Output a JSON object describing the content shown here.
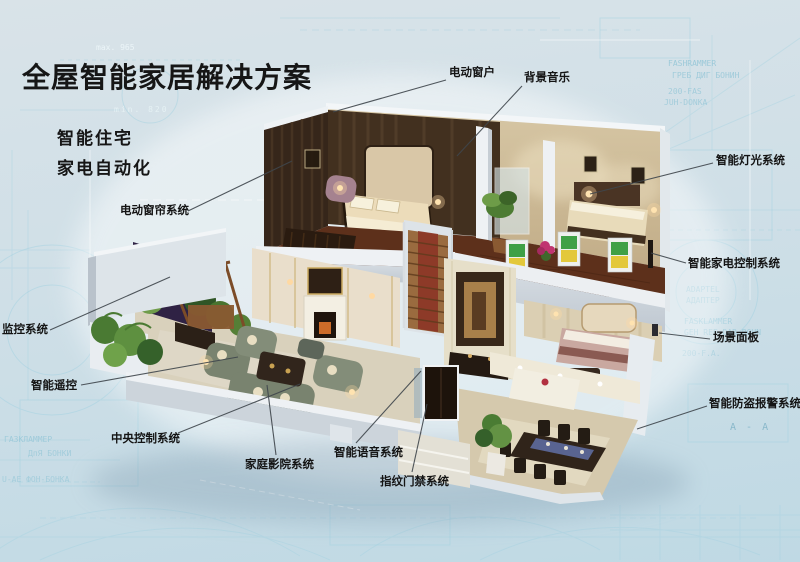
{
  "title": "全屋智能家居解决方案",
  "subtitles": [
    "智能住宅",
    "家电自动化"
  ],
  "callouts": [
    {
      "id": "electric-window",
      "text": "电动窗户"
    },
    {
      "id": "background-music",
      "text": "背景音乐"
    },
    {
      "id": "smart-lighting",
      "text": "智能灯光系统"
    },
    {
      "id": "smart-appliance-control",
      "text": "智能家电控制系统"
    },
    {
      "id": "scene-panel",
      "text": "场景面板"
    },
    {
      "id": "anti-theft-alarm",
      "text": "智能防盗报警系统"
    },
    {
      "id": "electric-curtain",
      "text": "电动窗帘系统"
    },
    {
      "id": "surveillance",
      "text": "监控系统"
    },
    {
      "id": "smart-remote",
      "text": "智能遥控"
    },
    {
      "id": "central-control",
      "text": "中央控制系统"
    },
    {
      "id": "home-theater",
      "text": "家庭影院系统"
    },
    {
      "id": "smart-voice",
      "text": "智能语音系统"
    },
    {
      "id": "fingerprint-access",
      "text": "指纹门禁系统"
    }
  ],
  "blueprint_marks": [
    "max. 965",
    "min. 820",
    "FASHRAMMER",
    "ГРЕБ ДИГ БОНИН",
    "200-FAS",
    "JUH-DONKA",
    "ADAPTEL",
    "АДАПТЕР",
    "FASKLAMMER",
    "GEH REF DAR BOHN",
    "200-F.A.",
    "A - A",
    "ГАЗКЛАММЕР",
    "ДпЯ БОНКИ",
    "U-АЕ ФОН-БОНКА"
  ],
  "colors": {
    "background_top": "#d9e3e8",
    "background_bottom": "#bfd9e4",
    "blueprint_line": "#9fd0e0",
    "title_color": "#161616",
    "label_color": "#141414",
    "leader_line": "#3f464c",
    "appliance_green": "#3fa046",
    "appliance_yellow": "#e3c83b"
  }
}
